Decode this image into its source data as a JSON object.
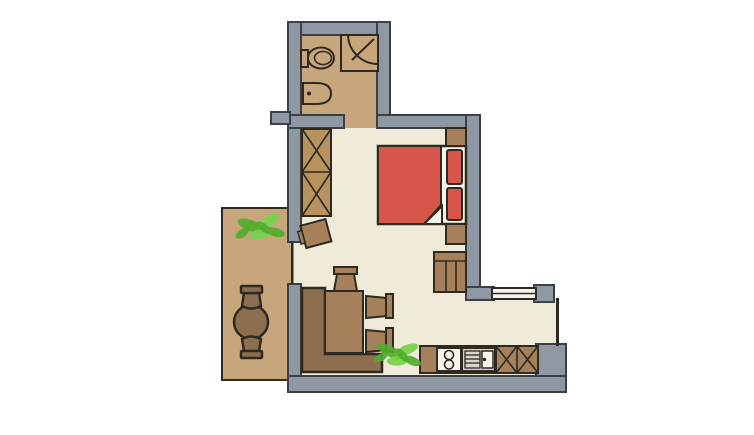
{
  "palette": {
    "background": "#ffffff",
    "wall": "#8e98a3",
    "wall_outline": "#3a4046",
    "floor_indoor": "#f0ebd9",
    "floor_tile": "#c8a67c",
    "furniture": "#a5805a",
    "furniture_dark": "#8d6e4e",
    "wardrobe": "#b8935f",
    "outline": "#2e2a22",
    "bed_red": "#d6564a",
    "white": "#f7f4ec",
    "sink_gray": "#d8d6ca",
    "plant_green": "#4fae2a",
    "plant_green_light": "#77d14b"
  },
  "floorplan": {
    "type": "apartment-floor-plan",
    "rooms": [
      {
        "name": "bathroom",
        "position": "top",
        "floor": "tile",
        "fixtures": [
          "toilet",
          "washbasin",
          "corner-shower"
        ],
        "openings": [
          "door-to-bedroom"
        ]
      },
      {
        "name": "bedroom-living-area",
        "position": "center",
        "floor": "indoor",
        "furniture": [
          "wardrobe-x-front",
          "side-chair",
          "double-bed-red",
          "pillow",
          "pillow",
          "nightstand-top",
          "nightstand-bottom",
          "dresser",
          "potted-plant"
        ],
        "openings": [
          "balcony-door",
          "door-to-bathroom"
        ]
      },
      {
        "name": "dining-corner",
        "position": "bottom-left-inside",
        "furniture": [
          "corner-bench-l-shape",
          "dining-table",
          "stool",
          "side-chair",
          "side-chair"
        ]
      },
      {
        "name": "kitchen",
        "position": "bottom-right",
        "fixtures": [
          "counter",
          "stove-two-burners",
          "kitchen-sink",
          "cabinet-x-front",
          "cabinet-x-front"
        ],
        "features": [
          "window-top",
          "glass-wall-right"
        ]
      },
      {
        "name": "balcony",
        "position": "left",
        "floor": "tile",
        "furniture": [
          "round-table",
          "stool",
          "stool",
          "potted-plant"
        ]
      }
    ],
    "features": [
      "gray-walls",
      "window-in-kitchen-wall",
      "balcony-sliding-door",
      "wall-stub-left-of-bathroom"
    ]
  }
}
